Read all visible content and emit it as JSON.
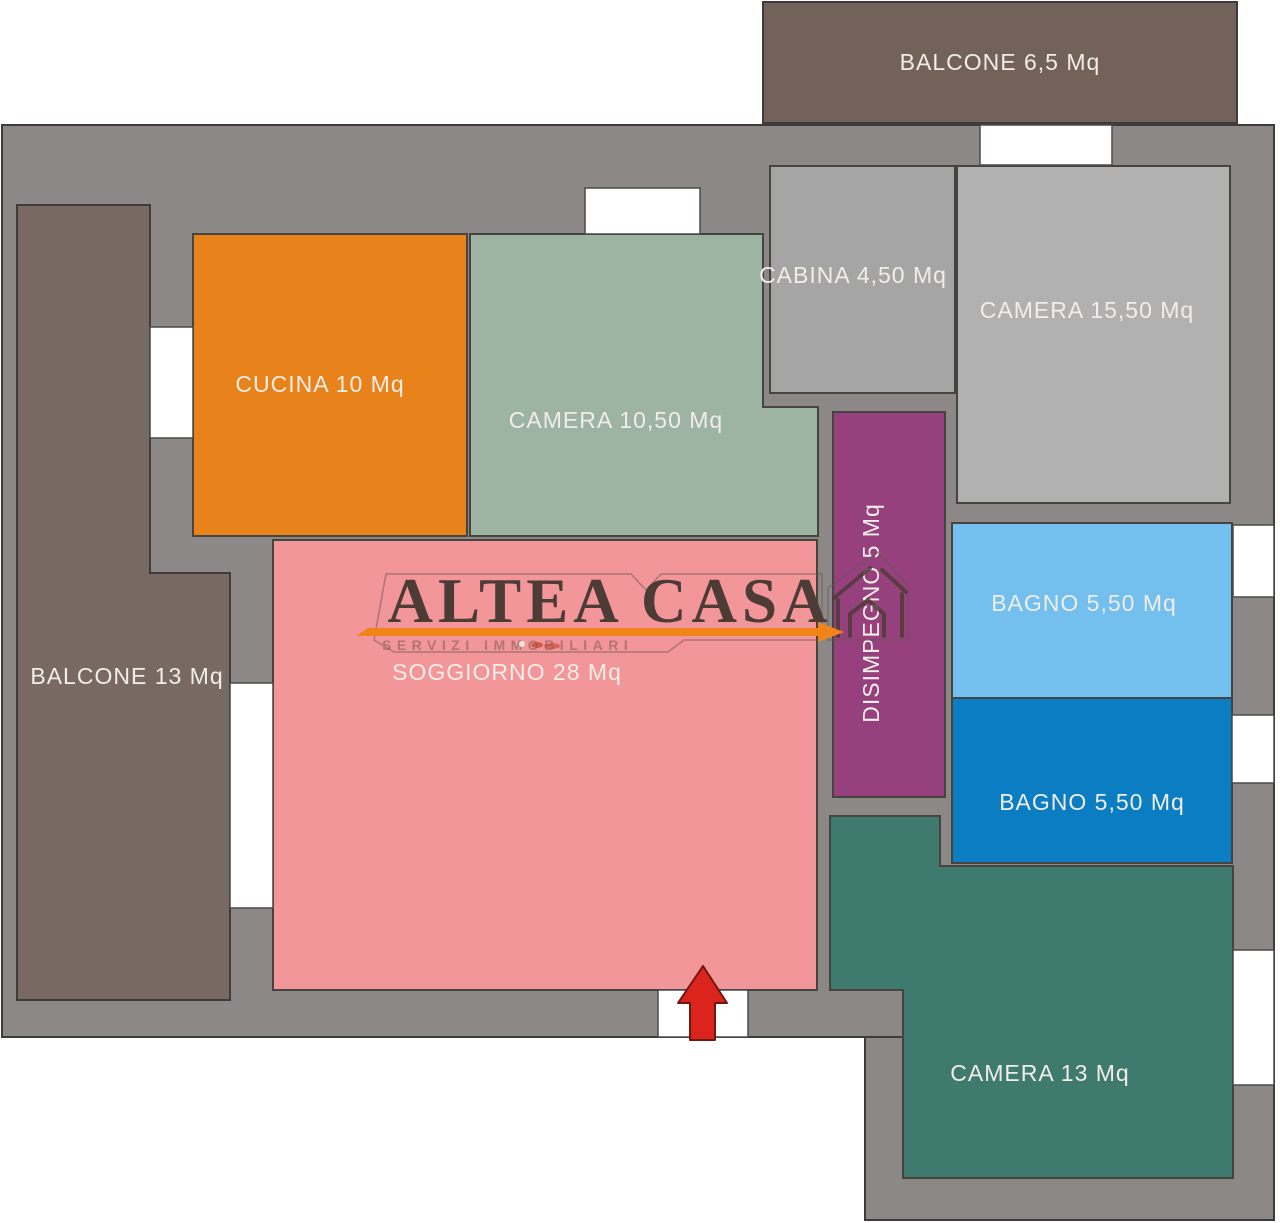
{
  "plan": {
    "walls": {
      "color": "#8B8887",
      "outline_color": "#3E3C3A",
      "label_text_color": "#F1EDE7"
    },
    "rooms": {
      "balcone_top": {
        "label": "BALCONE 6,5 Mq",
        "color": "#73625A"
      },
      "cabina": {
        "label": "CABINA 4,50 Mq",
        "color": "#A6A5A5"
      },
      "camera_15": {
        "label": "CAMERA 15,50 Mq",
        "color": "#B2B1B1"
      },
      "cucina": {
        "label": "CUCINA 10 Mq",
        "color": "#E8831B"
      },
      "camera_10": {
        "label": "CAMERA 10,50 Mq",
        "color": "#9EB4A3"
      },
      "balcone_left": {
        "label": "BALCONE 13 Mq",
        "color": "#786A62"
      },
      "soggiorno": {
        "label": "SOGGIORNO 28 Mq",
        "color": "#F29699"
      },
      "disimpegno": {
        "label": "DISIMPEGNO 5 Mq",
        "color": "#96417E"
      },
      "bagno_1": {
        "label": "BAGNO 5,50 Mq",
        "color": "#73BFED"
      },
      "bagno_2": {
        "label": "BAGNO 5,50 Mq",
        "color": "#0A7DC3"
      },
      "camera_13": {
        "label": "CAMERA 13 Mq",
        "color": "#3E7B6E"
      }
    },
    "entrance": {
      "arrow_color": "#DB251C"
    },
    "watermark": {
      "brand": "ALTEA CASA",
      "tagline": "SERVIZI IMMOBILIARI",
      "brand_color": "#4D3B35",
      "accent_color": "#F08419"
    }
  }
}
